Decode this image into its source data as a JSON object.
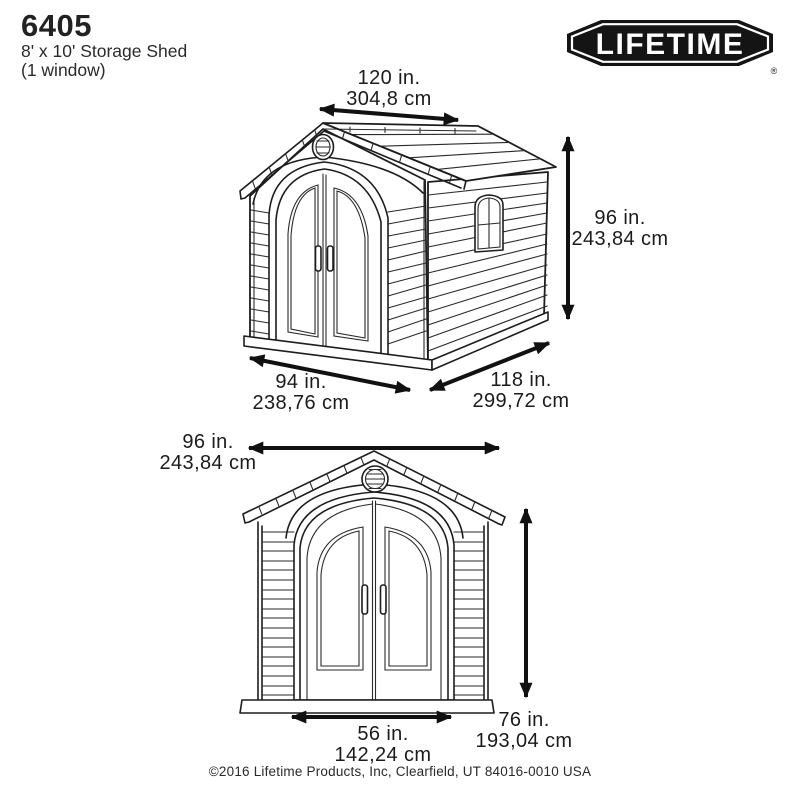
{
  "header": {
    "model": "6405",
    "subtitle1": "8' x 10' Storage Shed",
    "subtitle2": "(1 window)"
  },
  "logo": {
    "text": "LIFETIME",
    "reg": "®"
  },
  "colors": {
    "ink": "#1d1d1d",
    "arrow": "#111111",
    "background": "#ffffff",
    "logo_badge": "#141414"
  },
  "top_view": {
    "view": "3d-perspective",
    "roof_width": {
      "in": "120 in.",
      "cm": "304,8 cm"
    },
    "height": {
      "in": "96 in.",
      "cm": "243,84 cm"
    },
    "front_width": {
      "in": "94 in.",
      "cm": "238,76 cm"
    },
    "depth": {
      "in": "118 in.",
      "cm": "299,72 cm"
    }
  },
  "front_view": {
    "view": "front-elevation",
    "width": {
      "in": "96 in.",
      "cm": "243,84 cm"
    },
    "door_width": {
      "in": "56 in.",
      "cm": "142,24 cm"
    },
    "door_height": {
      "in": "76 in.",
      "cm": "193,04 cm"
    }
  },
  "footer": {
    "copyright": "©2016 Lifetime Products, Inc, Clearfield, UT 84016-0010 USA"
  }
}
